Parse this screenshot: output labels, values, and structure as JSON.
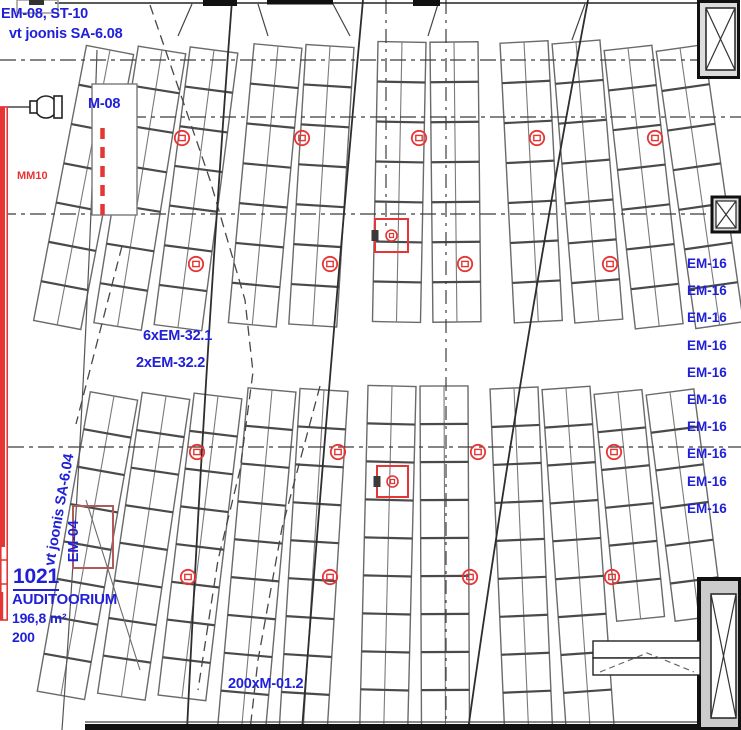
{
  "annotations": {
    "top_left_line1": "EM-08, ST-10",
    "top_left_line2": "vt joonis SA-6.08",
    "m08_label": "M-08",
    "mm10_label": "MM10",
    "em32_line1": "6xEM-32.1",
    "em32_line2": "2xEM-32.2",
    "sa604_label": "vt joonis SA-6.04",
    "em04_label": "EM-04",
    "seat_type_label": "200xM-01.2",
    "em16_labels": [
      "EM-16",
      "EM-16",
      "EM-16",
      "EM-16",
      "EM-16",
      "EM-16",
      "EM-16",
      "EM-16",
      "EM-16",
      "EM-16"
    ]
  },
  "room": {
    "number": "1021",
    "name": "AUDITOORIUM",
    "area": "196,8 m²",
    "capacity": "200"
  },
  "colors": {
    "annotation_blue": "#2020d8",
    "marker_red": "#e53534",
    "wall_black": "#161616",
    "seat_grey": "#5a5a5a"
  },
  "floorplan": {
    "ladder_width": 48,
    "ladder_step": 52,
    "fan_center_x": 436,
    "upper_angle_divisor": 30,
    "lower_angle_divisor": 32,
    "upper_sections": [
      {
        "x": 86,
        "y": 50,
        "ladders": 3,
        "rows": 7,
        "row_h": 40
      },
      {
        "x": 254,
        "y": 46,
        "ladders": 2,
        "rows": 7,
        "row_h": 40
      },
      {
        "x": 378,
        "y": 42,
        "ladders": 2,
        "rows": 7,
        "row_h": 40
      },
      {
        "x": 500,
        "y": 42,
        "ladders": 2,
        "rows": 7,
        "row_h": 40
      },
      {
        "x": 604,
        "y": 48,
        "ladders": 2,
        "rows": 7,
        "row_h": 40
      }
    ],
    "lower_sections": [
      {
        "x": 90,
        "y": 396,
        "ladders": 3,
        "rows": 8,
        "row_h": 38
      },
      {
        "x": 248,
        "y": 390,
        "ladders": 2,
        "rows": 9,
        "row_h": 38
      },
      {
        "x": 368,
        "y": 386,
        "ladders": 2,
        "rows": 9,
        "row_h": 38
      },
      {
        "x": 490,
        "y": 388,
        "ladders": 2,
        "rows": 9,
        "row_h": 38
      },
      {
        "x": 594,
        "y": 392,
        "ladders": 2,
        "rows": 6,
        "row_h": 38
      }
    ]
  },
  "symbols": {
    "circle_markers": [
      {
        "x": 182,
        "y": 138
      },
      {
        "x": 302,
        "y": 138
      },
      {
        "x": 419,
        "y": 138
      },
      {
        "x": 537,
        "y": 138
      },
      {
        "x": 655,
        "y": 138
      },
      {
        "x": 196,
        "y": 264
      },
      {
        "x": 330,
        "y": 264
      },
      {
        "x": 465,
        "y": 264
      },
      {
        "x": 610,
        "y": 264
      },
      {
        "x": 197,
        "y": 452
      },
      {
        "x": 338,
        "y": 452
      },
      {
        "x": 478,
        "y": 452
      },
      {
        "x": 614,
        "y": 452
      },
      {
        "x": 188,
        "y": 577
      },
      {
        "x": 330,
        "y": 577
      },
      {
        "x": 470,
        "y": 577
      },
      {
        "x": 612,
        "y": 577
      }
    ],
    "box_markers": [
      {
        "x": 375,
        "y": 219,
        "size": 33
      },
      {
        "x": 377,
        "y": 466,
        "size": 31
      }
    ]
  }
}
